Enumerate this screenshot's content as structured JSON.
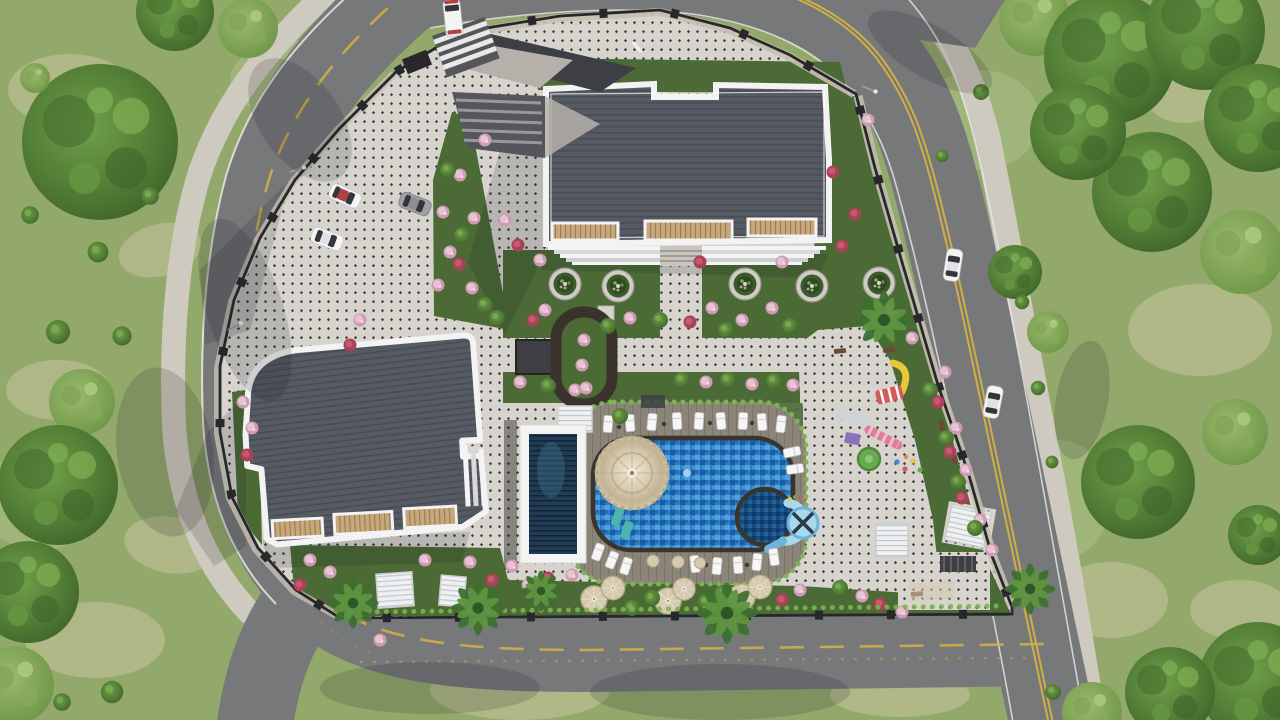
{
  "meta": {
    "title": "Aerial site plan render — residential complex",
    "type": "3d-architectural-render",
    "view": "top-down aerial"
  },
  "colors": {
    "grass": "#93a96c",
    "grassLight": "#aec187",
    "grassDry": "#c6c49c",
    "road": "#77787a",
    "sidewalk": "#cfcabf",
    "curb": "#e9e8e3",
    "yellow": "#cfae45",
    "pavement": "#d7d4ce",
    "dot": "#3f3f41",
    "wall": "#28282c",
    "wallLight": "#c6c0b3",
    "garden": "#4b6a36",
    "hedge": "#7cb450",
    "roof": "#565a63",
    "roofLine": "#484c55",
    "trim": "#f3f3f4",
    "tan": "#c7a87c",
    "tanLine": "#9b7a50",
    "deck": "#8b8478",
    "deckLine": "#7a7367",
    "water": "#2e7ec4",
    "waterDeep": "#1c5ba6",
    "waterLight": "#58abe0",
    "poolEdge": "#3a342d",
    "spa": "#164a80",
    "slide": "#a9d9ec",
    "slideDeep": "#6db4d8",
    "parasol": "#d9cdb2",
    "parasolEdge": "#b8ab8c",
    "umbrella": "#d5c9ae",
    "pergola": "#eef0f2",
    "pergolaLine": "#c3c7cb",
    "darkStruct": "#3e3f45",
    "ramp": "#55565c",
    "rampLine": "#97989d",
    "wedge": "#b5b1aa",
    "carWhite": "#f4f4f4",
    "carGray": "#9fa0a3",
    "glass": "#33363d",
    "carRed": "#b34040",
    "flowerPink": "#cf9ab3",
    "flowerPinkLight": "#e4c3d2",
    "flowerRed": "#aa4156",
    "playYellow": "#e6c83a",
    "playRed": "#d25c5c",
    "playGreen": "#68aa50",
    "playPurple": "#8a70bd",
    "playPink": "#dd7f98",
    "wood": "#6b4a32",
    "shadow": "rgba(25,26,32,0.16)"
  },
  "scene": {
    "buildings": [
      {
        "name": "north block",
        "roof": "dark gray ridged roof, white trim, tan balconies"
      },
      {
        "name": "west block",
        "roof": "dark gray ridged roof, white trim, tan balconies"
      }
    ],
    "amenities": [
      "main swimming pool",
      "round spa pool",
      "looping water slide",
      "lap pool",
      "scalloped fountain parasol",
      "kids playground",
      "pergolas",
      "sun loungers",
      "beige lounge umbrellas",
      "oval garden walkway",
      "round tree planters"
    ],
    "vehicle_counts": {
      "parked_cars": 3,
      "street_cars": 2,
      "entrance_van": 1
    },
    "planter_count": 5,
    "roads": [
      "west perimeter road",
      "north road",
      "east road",
      "south road"
    ]
  }
}
